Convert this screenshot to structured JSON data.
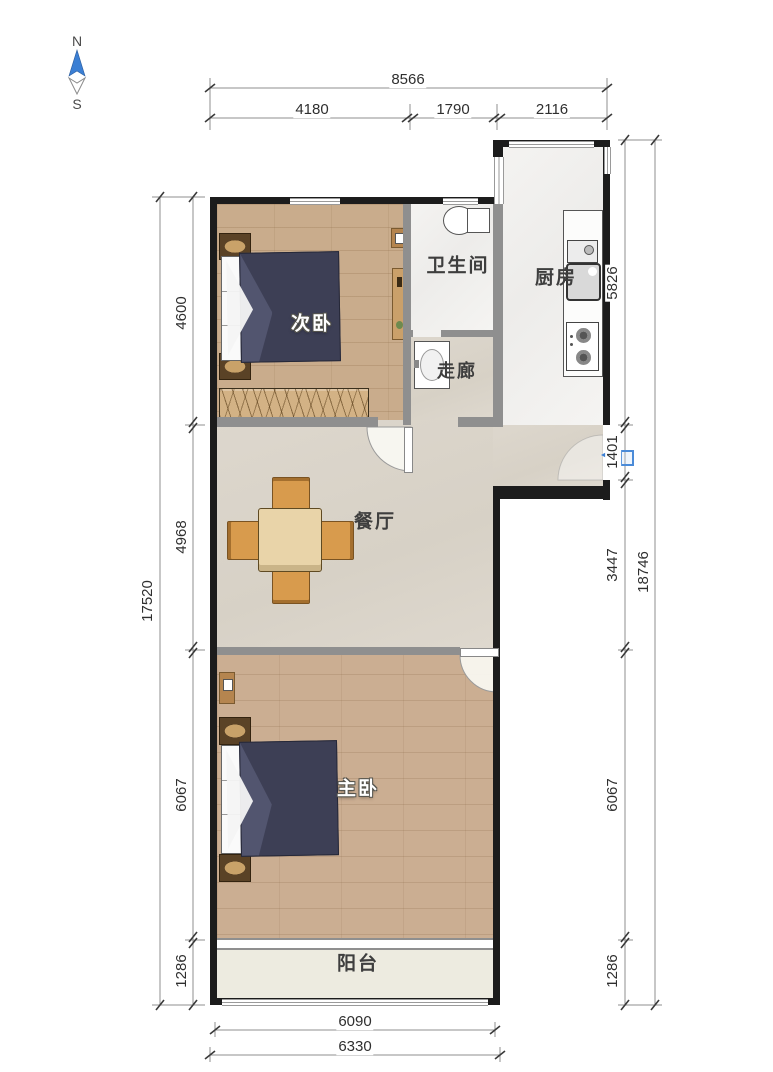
{
  "compass": {
    "north": "N",
    "south": "S"
  },
  "rooms": {
    "secondary_bedroom": "次卧",
    "bathroom": "卫生间",
    "kitchen": "厨房",
    "corridor": "走廊",
    "dining_room": "餐厅",
    "master_bedroom": "主卧",
    "balcony": "阳台"
  },
  "dimensions": {
    "top": {
      "total": "8566",
      "segments": [
        "4180",
        "1790",
        "2116"
      ]
    },
    "left": {
      "total": "17520",
      "segments": [
        "4600",
        "4968",
        "6067",
        "1286"
      ]
    },
    "right": {
      "total": "18746",
      "segments": [
        "5826",
        "1401",
        "3447",
        "6067",
        "1286"
      ]
    },
    "bottom": {
      "inner": "6090",
      "outer": "6330"
    }
  },
  "colors": {
    "exterior_wall": "#1c1c1c",
    "interior_wall": "#8f8f8f",
    "wood_floor": "#c9ac8c",
    "tile_floor": "#f2f1ef",
    "greige_floor": "#dbd5cb",
    "balcony_floor": "#edebe0",
    "bed_duvet": "#3d3f55",
    "chair_wood": "#d89b4d",
    "entrance_blue": "#3b7fd4"
  }
}
